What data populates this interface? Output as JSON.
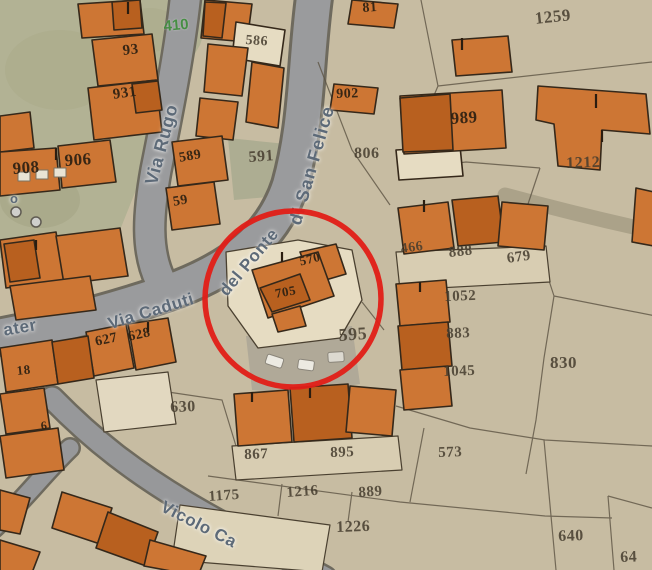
{
  "streets": {
    "rugo": "Via Rugo",
    "caduti": "Via Caduti",
    "ponte": "del Ponte",
    "san_felice": "di San Felice",
    "ater": "ater",
    "vicolo": "Vicolo Ca",
    "road_mark": "o"
  },
  "green_label": "410",
  "parcels": [
    {
      "text": "93"
    },
    {
      "text": "931"
    },
    {
      "text": "908"
    },
    {
      "text": "906"
    },
    {
      "text": "586"
    },
    {
      "text": "589"
    },
    {
      "text": "59"
    },
    {
      "text": "591"
    },
    {
      "text": "81"
    },
    {
      "text": "902"
    },
    {
      "text": "806"
    },
    {
      "text": "989"
    },
    {
      "text": "1259"
    },
    {
      "text": "1212"
    },
    {
      "text": "466"
    },
    {
      "text": "888"
    },
    {
      "text": "679"
    },
    {
      "text": "1052"
    },
    {
      "text": "883"
    },
    {
      "text": "1045"
    },
    {
      "text": "830"
    },
    {
      "text": "595"
    },
    {
      "text": "570"
    },
    {
      "text": "705"
    },
    {
      "text": "627"
    },
    {
      "text": "628"
    },
    {
      "text": "18"
    },
    {
      "text": "6"
    },
    {
      "text": "630"
    },
    {
      "text": "867"
    },
    {
      "text": "895"
    },
    {
      "text": "573"
    },
    {
      "text": "1175"
    },
    {
      "text": "1216"
    },
    {
      "text": "889"
    },
    {
      "text": "1226"
    },
    {
      "text": "640"
    },
    {
      "text": "64"
    }
  ],
  "colors": {
    "ground": "#c7bca2",
    "park": "#b2b294",
    "road": "#9a9b9d",
    "building": "#cd7634",
    "building_dark": "#b8601f",
    "courtyard": "#e6dcc2",
    "highlight_circle": "#e11d17",
    "street_text": "#5d6a78",
    "parcel_text": "#453c2e",
    "green_text": "#3e8d3b"
  }
}
